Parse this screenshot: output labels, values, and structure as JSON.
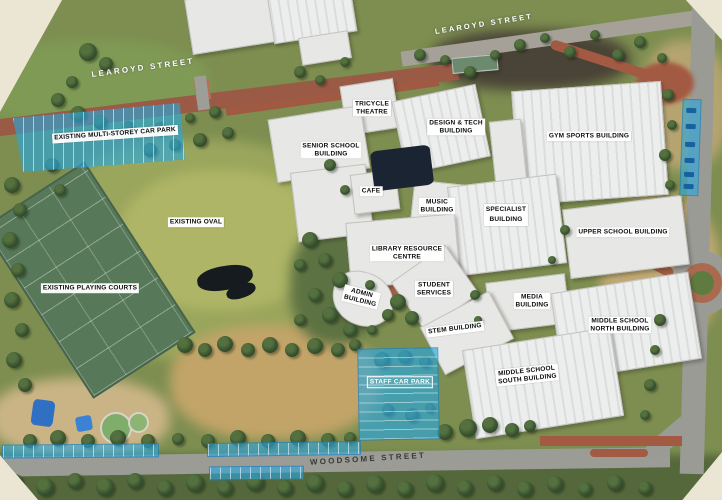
{
  "title": "Annotated aerial campus site plan",
  "colors": {
    "highlight_blue": "#2AA7DE",
    "label_background": "#FFFFFF",
    "label_text": "#0D0D0D",
    "street_text_light": "#FFFFFF",
    "street_text_dark": "#3A3A36",
    "background_cream": "#EBE5D3"
  },
  "labels": [
    {
      "id": "learoyd-street-west",
      "text": "LEAROYD STREET"
    },
    {
      "id": "learoyd-street-east",
      "text": "LEAROYD STREET"
    },
    {
      "id": "woodsome-street",
      "text": "WOODSOME STREET"
    },
    {
      "id": "existing-multi-storey-car-park",
      "text": "EXISTING MULTI-STOREY CAR PARK"
    },
    {
      "id": "tricycle-theatre",
      "text": "TRICYCLE\nTHEATRE"
    },
    {
      "id": "design-tech-building",
      "text": "DESIGN & TECH\nBUILDING"
    },
    {
      "id": "gym-sports-building",
      "text": "GYM SPORTS BUILDING"
    },
    {
      "id": "senior-school-building",
      "text": "SENIOR SCHOOL\nBUILDING"
    },
    {
      "id": "cafe",
      "text": "CAFE"
    },
    {
      "id": "music-building",
      "text": "MUSIC\nBUILDING"
    },
    {
      "id": "specialist-building",
      "text": "SPECIALIST\nBUILDING"
    },
    {
      "id": "existing-oval",
      "text": "EXISTING OVAL"
    },
    {
      "id": "upper-school-building",
      "text": "UPPER SCHOOL BUILDING"
    },
    {
      "id": "library-resource-centre",
      "text": "LIBRARY RESOURCE\nCENTRE"
    },
    {
      "id": "existing-playing-courts",
      "text": "EXISTING PLAYING COURTS"
    },
    {
      "id": "admin-building",
      "text": "ADMIN\nBUILDING"
    },
    {
      "id": "student-services",
      "text": "STUDENT\nSERVICES"
    },
    {
      "id": "media-building",
      "text": "MEDIA\nBUILDING"
    },
    {
      "id": "middle-school-north-building",
      "text": "MIDDLE SCHOOL\nNORTH BUILDING"
    },
    {
      "id": "stem-building",
      "text": "STEM BUILDING"
    },
    {
      "id": "middle-school-south-building",
      "text": "MIDDLE SCHOOL\nSOUTH BUILDING"
    },
    {
      "id": "staff-car-park",
      "text": "STAFF CAR PARK"
    }
  ],
  "highlighted_zones": [
    "existing-multi-storey-car-park",
    "staff-car-park",
    "on-street-parking-woodsome-north",
    "on-street-parking-woodsome-south",
    "on-street-parking-east-road"
  ]
}
